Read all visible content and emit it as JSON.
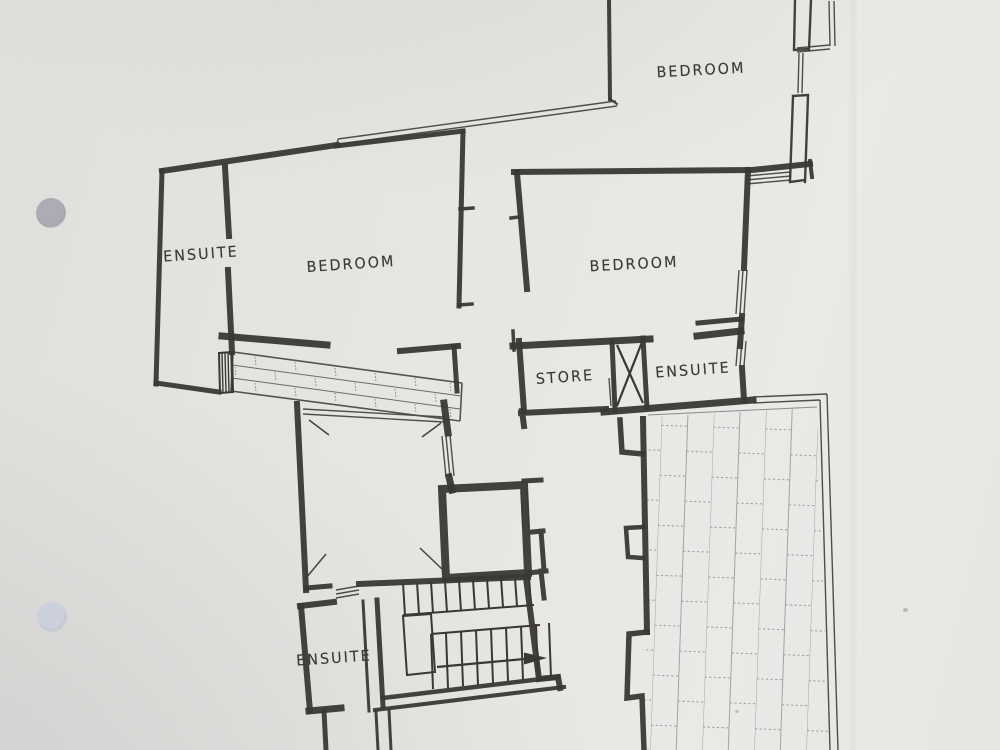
{
  "floor_plan": {
    "rooms": [
      {
        "id": "bedroom-top-right",
        "label": "BEDROOM"
      },
      {
        "id": "ensuite-upper-left",
        "label": "ENSUITE"
      },
      {
        "id": "bedroom-upper-left",
        "label": "BEDROOM"
      },
      {
        "id": "bedroom-middle-right",
        "label": "BEDROOM"
      },
      {
        "id": "store",
        "label": "STORE"
      },
      {
        "id": "ensuite-middle-right",
        "label": "ENSUITE"
      },
      {
        "id": "ensuite-lower-left",
        "label": "ENSUITE"
      }
    ],
    "symbols": {
      "stair_direction_arrow": "right-arrow",
      "shaft_marker": "x-cross",
      "terrace_surface": "vertical-brick-paving",
      "wall_band": "brick-course-band",
      "void_corners": "diagonal-corner-ticks"
    },
    "colors": {
      "paper": "#e6e5e2",
      "ink": "#3a3833",
      "thin_line": "#504e49",
      "brick_joint": "#94949c",
      "hole_punch_top": "#a8a9b2",
      "hole_punch_bottom": "#c8ccda"
    }
  }
}
